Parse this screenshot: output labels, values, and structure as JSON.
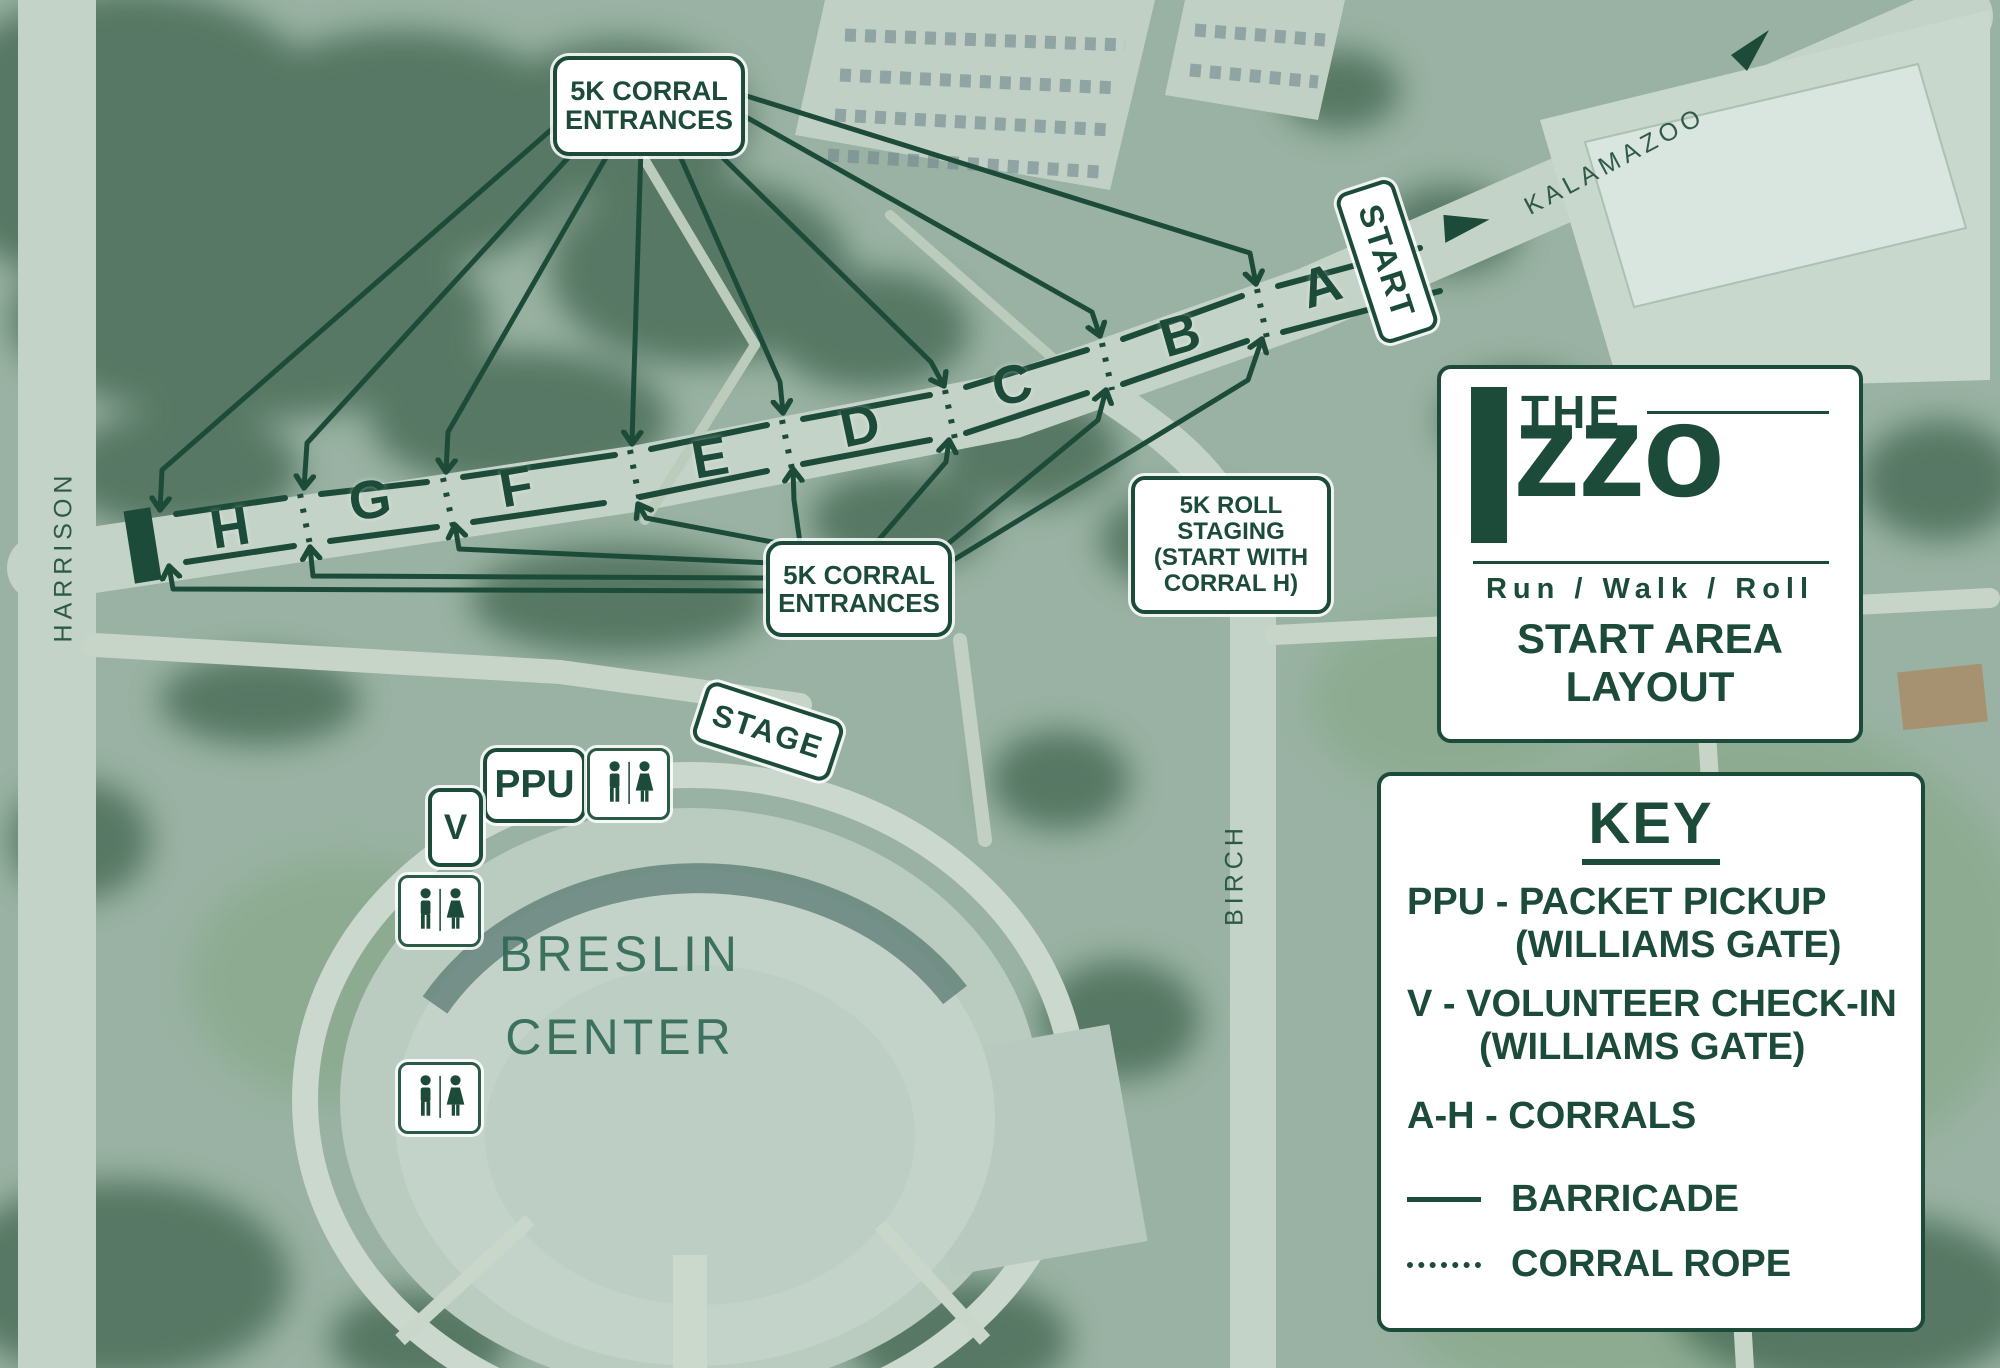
{
  "colors": {
    "accent": "#1d4b39",
    "card_bg": "#ffffff"
  },
  "streets": {
    "harrison": "HARRISON",
    "kalamazoo": "KALAMAZOO",
    "birch": "BIRCH"
  },
  "building": {
    "name_line1": "BRESLIN",
    "name_line2": "CENTER"
  },
  "corrals": {
    "letters": [
      "A",
      "B",
      "C",
      "D",
      "E",
      "F",
      "G",
      "H"
    ]
  },
  "labels": {
    "corral_entrances_top": {
      "line1": "5K CORRAL",
      "line2": "ENTRANCES"
    },
    "corral_entrances_bottom": {
      "line1": "5K CORRAL",
      "line2": "ENTRANCES"
    },
    "roll_staging": {
      "line1": "5K ROLL",
      "line2": "STAGING",
      "line3": "(START WITH",
      "line4": "CORRAL H)"
    },
    "start": "START",
    "stage": "STAGE",
    "ppu": "PPU",
    "volunteer_checkin": "V"
  },
  "logo": {
    "the": "THE",
    "izzo_wordmark": "zzo",
    "tagline": "Run / Walk / Roll",
    "subtitle_line1": "START AREA",
    "subtitle_line2": "LAYOUT"
  },
  "key": {
    "title": "KEY",
    "items": [
      {
        "label": "PPU - PACKET PICKUP",
        "sub": "(WILLIAMS GATE)"
      },
      {
        "label": "V - VOLUNTEER CHECK-IN",
        "sub": "(WILLIAMS GATE)"
      },
      {
        "label": "A-H - CORRALS",
        "sub": ""
      }
    ],
    "legend": [
      {
        "symbol": "barricade-solid-line",
        "label": "BARRICADE"
      },
      {
        "symbol": "corral-rope-dotted-line",
        "label": "CORRAL ROPE"
      }
    ]
  },
  "icons": {
    "restroom": "restroom-icon",
    "course_arrow": "course-direction-arrow"
  }
}
